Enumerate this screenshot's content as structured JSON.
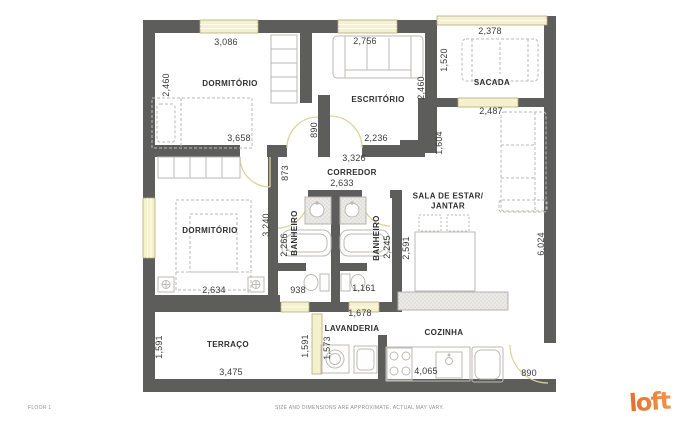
{
  "footer": {
    "floor_label": "FLOOR 1",
    "disclaimer": "SIZE AND DIMENSIONS ARE APPROXIMATE. ACTUAL MAY VARY.",
    "brand": "loft"
  },
  "colors": {
    "wall": "#5d5d5c",
    "window_fill": "#f5f1cd",
    "window_border": "#b3ab7c",
    "door_arc": "#ddd49c",
    "furniture": "#bcbab5",
    "hatch_bg": "#eceae6",
    "room_text": "#2f2f2f",
    "dim_text": "#3a3a3a",
    "brand_orange": "#ed7d31"
  },
  "floorplan": {
    "rooms": [
      {
        "text": "DORMITÓRIO",
        "x": 230,
        "y": 84
      },
      {
        "text": "ESCRITÓRIO",
        "x": 378,
        "y": 100
      },
      {
        "text": "SACADA",
        "x": 492,
        "y": 83
      },
      {
        "text": "CORREDOR",
        "x": 352,
        "y": 173
      },
      {
        "text": "SALA DE ESTAR/\nJANTAR",
        "x": 448,
        "y": 202
      },
      {
        "text": "DORMITÓRIO",
        "x": 210,
        "y": 231
      },
      {
        "text": "BANHEIRO",
        "x": 295,
        "y": 233,
        "vertical": true
      },
      {
        "text": "BANHEIRO",
        "x": 377,
        "y": 238,
        "vertical": true
      },
      {
        "text": "TERRAÇO",
        "x": 228,
        "y": 345
      },
      {
        "text": "LAVANDERIA",
        "x": 352,
        "y": 329
      },
      {
        "text": "COZINHA",
        "x": 444,
        "y": 333
      }
    ],
    "dimensions": [
      {
        "text": "3,086",
        "x": 226,
        "y": 43
      },
      {
        "text": "2,756",
        "x": 365,
        "y": 42
      },
      {
        "text": "2,378",
        "x": 490,
        "y": 32
      },
      {
        "text": "3,658",
        "x": 239,
        "y": 139
      },
      {
        "text": "2,236",
        "x": 376,
        "y": 139
      },
      {
        "text": "2,487",
        "x": 491,
        "y": 112
      },
      {
        "text": "3,326",
        "x": 354,
        "y": 159
      },
      {
        "text": "2,633",
        "x": 342,
        "y": 184
      },
      {
        "text": "2,634",
        "x": 214,
        "y": 291
      },
      {
        "text": "938",
        "x": 298,
        "y": 291
      },
      {
        "text": "1,161",
        "x": 364,
        "y": 289
      },
      {
        "text": "1,678",
        "x": 360,
        "y": 314
      },
      {
        "text": "3,475",
        "x": 231,
        "y": 373
      },
      {
        "text": "4,065",
        "x": 426,
        "y": 372
      },
      {
        "text": "890",
        "x": 529,
        "y": 374
      },
      {
        "text": "2,460",
        "x": 167,
        "y": 85,
        "vertical": true
      },
      {
        "text": "2,460",
        "x": 422,
        "y": 88,
        "vertical": true
      },
      {
        "text": "1,520",
        "x": 445,
        "y": 60,
        "vertical": true
      },
      {
        "text": "890",
        "x": 315,
        "y": 130,
        "vertical": true
      },
      {
        "text": "873",
        "x": 286,
        "y": 173,
        "vertical": true
      },
      {
        "text": "1,604",
        "x": 440,
        "y": 143,
        "vertical": true
      },
      {
        "text": "2,591",
        "x": 407,
        "y": 248,
        "vertical": true
      },
      {
        "text": "6,024",
        "x": 542,
        "y": 244,
        "vertical": true
      },
      {
        "text": "3,240",
        "x": 267,
        "y": 225,
        "vertical": true
      },
      {
        "text": "2,266",
        "x": 285,
        "y": 245,
        "vertical": true
      },
      {
        "text": "2,245",
        "x": 388,
        "y": 247,
        "vertical": true
      },
      {
        "text": "1,591",
        "x": 160,
        "y": 347,
        "vertical": true
      },
      {
        "text": "1,591",
        "x": 306,
        "y": 346,
        "vertical": true
      },
      {
        "text": "1,573",
        "x": 328,
        "y": 348,
        "vertical": true
      }
    ]
  }
}
